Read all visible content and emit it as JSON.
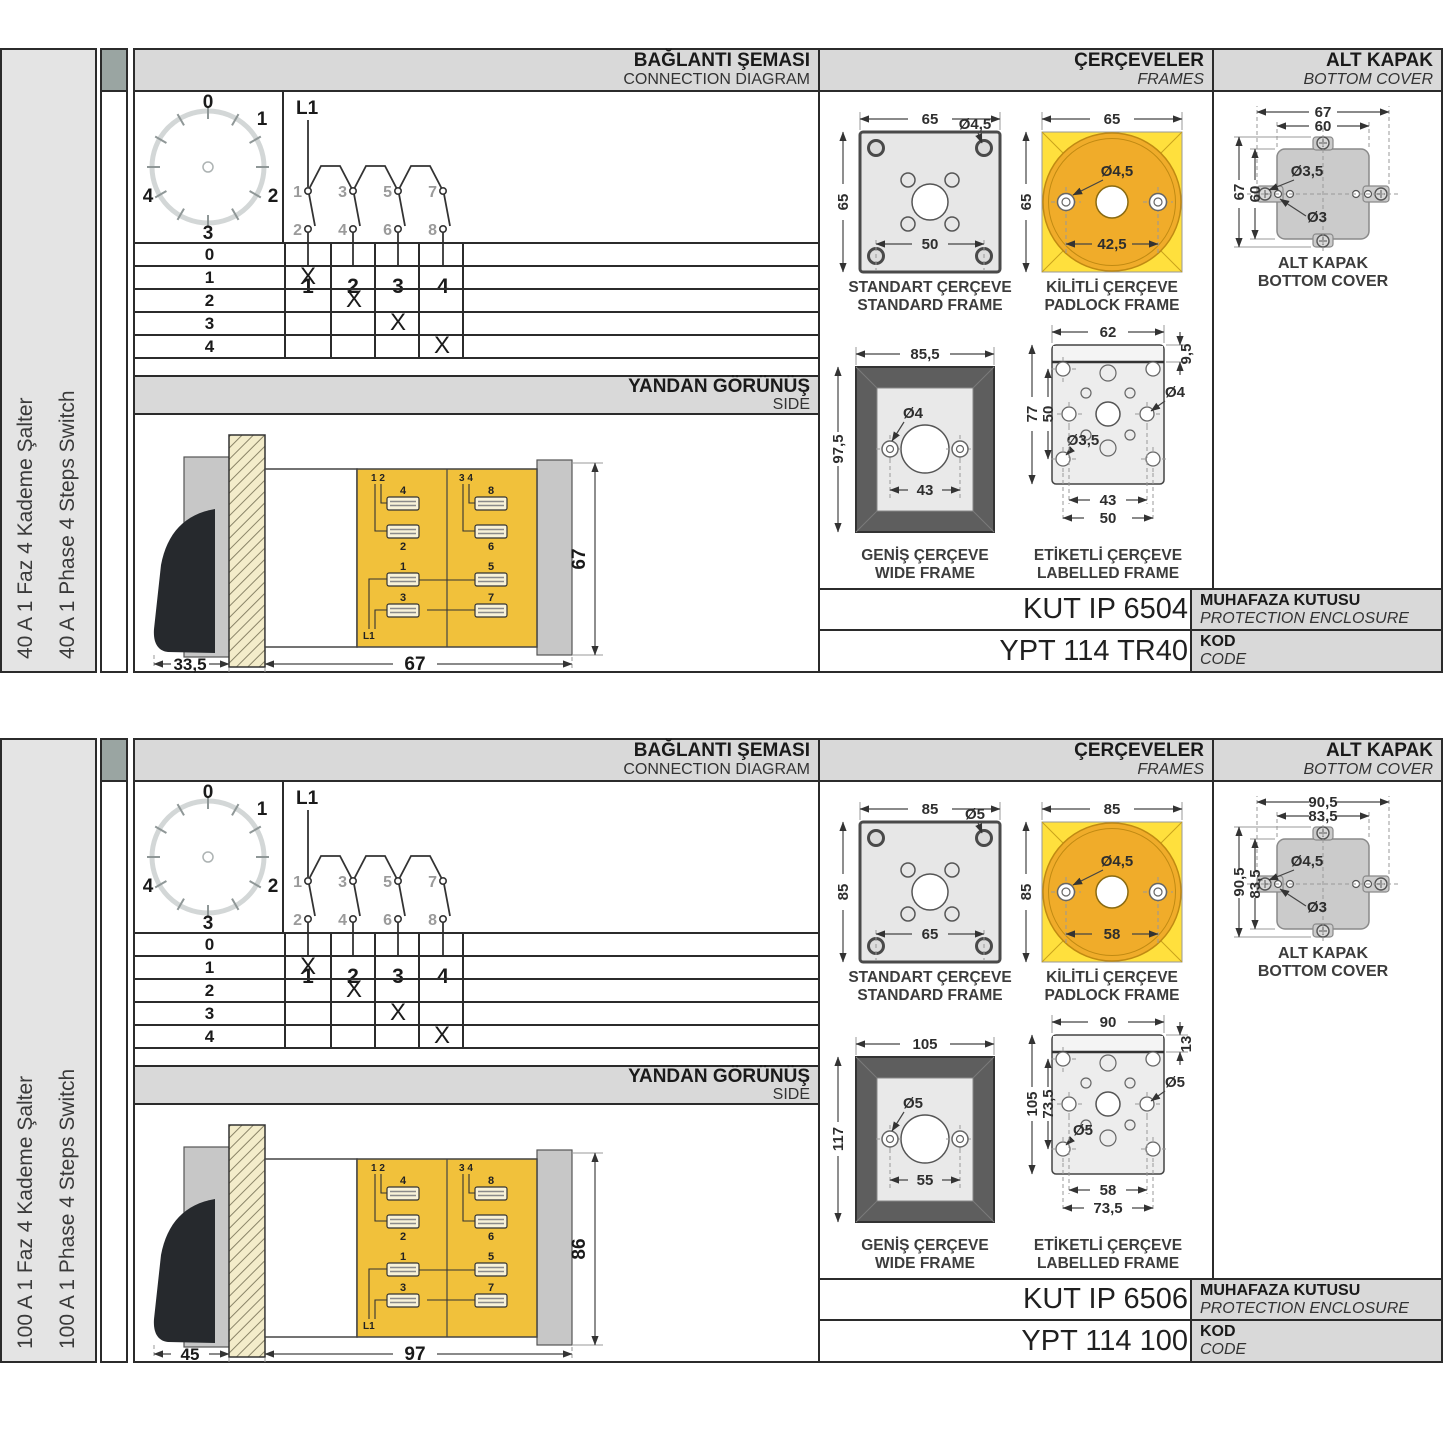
{
  "shared": {
    "headers": {
      "conn_tr": "BAĞLANTI ŞEMASI",
      "conn_en": "CONNECTION DIAGRAM",
      "frames_tr": "ÇERÇEVELER",
      "frames_en": "FRAMES",
      "cover_tr": "ALT KAPAK",
      "cover_en": "BOTTOM COVER",
      "side_tr": "YANDAN GÖRÜNÜŞ",
      "side_en": "SIDE"
    },
    "dial": {
      "labels": [
        "0",
        "1",
        "2",
        "3",
        "4"
      ]
    },
    "circuit": {
      "feed": "L1",
      "top": [
        "1",
        "3",
        "5",
        "7"
      ],
      "bottom": [
        "2",
        "4",
        "6",
        "8"
      ],
      "out": [
        "1",
        "2",
        "3",
        "4"
      ]
    },
    "table": {
      "rows": [
        {
          "step": "0",
          "marks": [
            "",
            "",
            "",
            ""
          ]
        },
        {
          "step": "1",
          "marks": [
            "X",
            "",
            "",
            ""
          ]
        },
        {
          "step": "2",
          "marks": [
            "",
            "X",
            "",
            ""
          ]
        },
        {
          "step": "3",
          "marks": [
            "",
            "",
            "X",
            ""
          ]
        },
        {
          "step": "4",
          "marks": [
            "",
            "",
            "",
            "X"
          ]
        }
      ]
    },
    "captions": {
      "std_tr": "STANDART ÇERÇEVE",
      "std_en": "STANDARD FRAME",
      "pad_tr": "KİLİTLİ ÇERÇEVE",
      "pad_en": "PADLOCK FRAME",
      "wide_tr": "GENİŞ ÇERÇEVE",
      "wide_en": "WIDE FRAME",
      "lab_tr": "ETİKETLİ ÇERÇEVE",
      "lab_en": "LABELLED FRAME",
      "cover_tr": "ALT KAPAK",
      "cover_en": "BOTTOM COVER"
    },
    "code_labels": {
      "enc_tr": "MUHAFAZA KUTUSU",
      "enc_en": "PROTECTION ENCLOSURE",
      "kod_tr": "KOD",
      "kod_en": "CODE"
    },
    "side_terminals": {
      "pair1": "1 2",
      "pair2": "3 4",
      "u1": "4",
      "u2": "2",
      "u3": "8",
      "u4": "6",
      "b1": "1",
      "b2": "3",
      "b3": "5",
      "b4": "7",
      "feed": "L1"
    },
    "colors": {
      "padlock_yellow": "#FFE03D",
      "padlock_orange": "#F0AC2A",
      "body_yellow": "#F1C13B",
      "header_gray": "#D9D9D9"
    }
  },
  "sections": [
    {
      "label_tr": "40 A 1 Faz 4 Kademe Şalter",
      "label_en": "40 A 1 Phase 4 Steps Switch",
      "std": {
        "w": "65",
        "h": "65",
        "hole": "Ø4,5",
        "pitch": "50"
      },
      "pad": {
        "w": "65",
        "h": "65",
        "hole": "Ø4,5",
        "pitch": "42,5"
      },
      "wide": {
        "w": "85,5",
        "h": "97,5",
        "hole": "Ø4",
        "pitch": "43"
      },
      "lab": {
        "w": "62",
        "strip": "9,5",
        "h": "77",
        "vpitch": "50",
        "hole_r": "Ø4",
        "hole_bl": "Ø3,5",
        "p1": "43",
        "p2": "50"
      },
      "cover": {
        "w1": "67",
        "w2": "60",
        "h1": "67",
        "h2": "60",
        "hole1": "Ø3,5",
        "hole2": "Ø3"
      },
      "side": {
        "d1": "33,5",
        "d2": "67",
        "dh": "67"
      },
      "codes": {
        "enclosure": "KUT IP 6504",
        "code": "YPT 114 TR40"
      }
    },
    {
      "label_tr": "100 A 1 Faz 4 Kademe Şalter",
      "label_en": "100 A 1 Phase 4 Steps Switch",
      "std": {
        "w": "85",
        "h": "85",
        "hole": "Ø5",
        "pitch": "65"
      },
      "pad": {
        "w": "85",
        "h": "85",
        "hole": "Ø4,5",
        "pitch": "58"
      },
      "wide": {
        "w": "105",
        "h": "117",
        "hole": "Ø5",
        "pitch": "55"
      },
      "lab": {
        "w": "90",
        "strip": "13",
        "h": "105",
        "vpitch": "73,5",
        "hole_r": "Ø5",
        "hole_bl": "Ø5",
        "p1": "58",
        "p2": "73,5"
      },
      "cover": {
        "w1": "90,5",
        "w2": "83,5",
        "h1": "90,5",
        "h2": "83,5",
        "hole1": "Ø4,5",
        "hole2": "Ø3"
      },
      "side": {
        "d1": "45",
        "d2": "97",
        "dh": "86"
      },
      "codes": {
        "enclosure": "KUT IP 6506",
        "code": "YPT 114 100"
      }
    }
  ]
}
